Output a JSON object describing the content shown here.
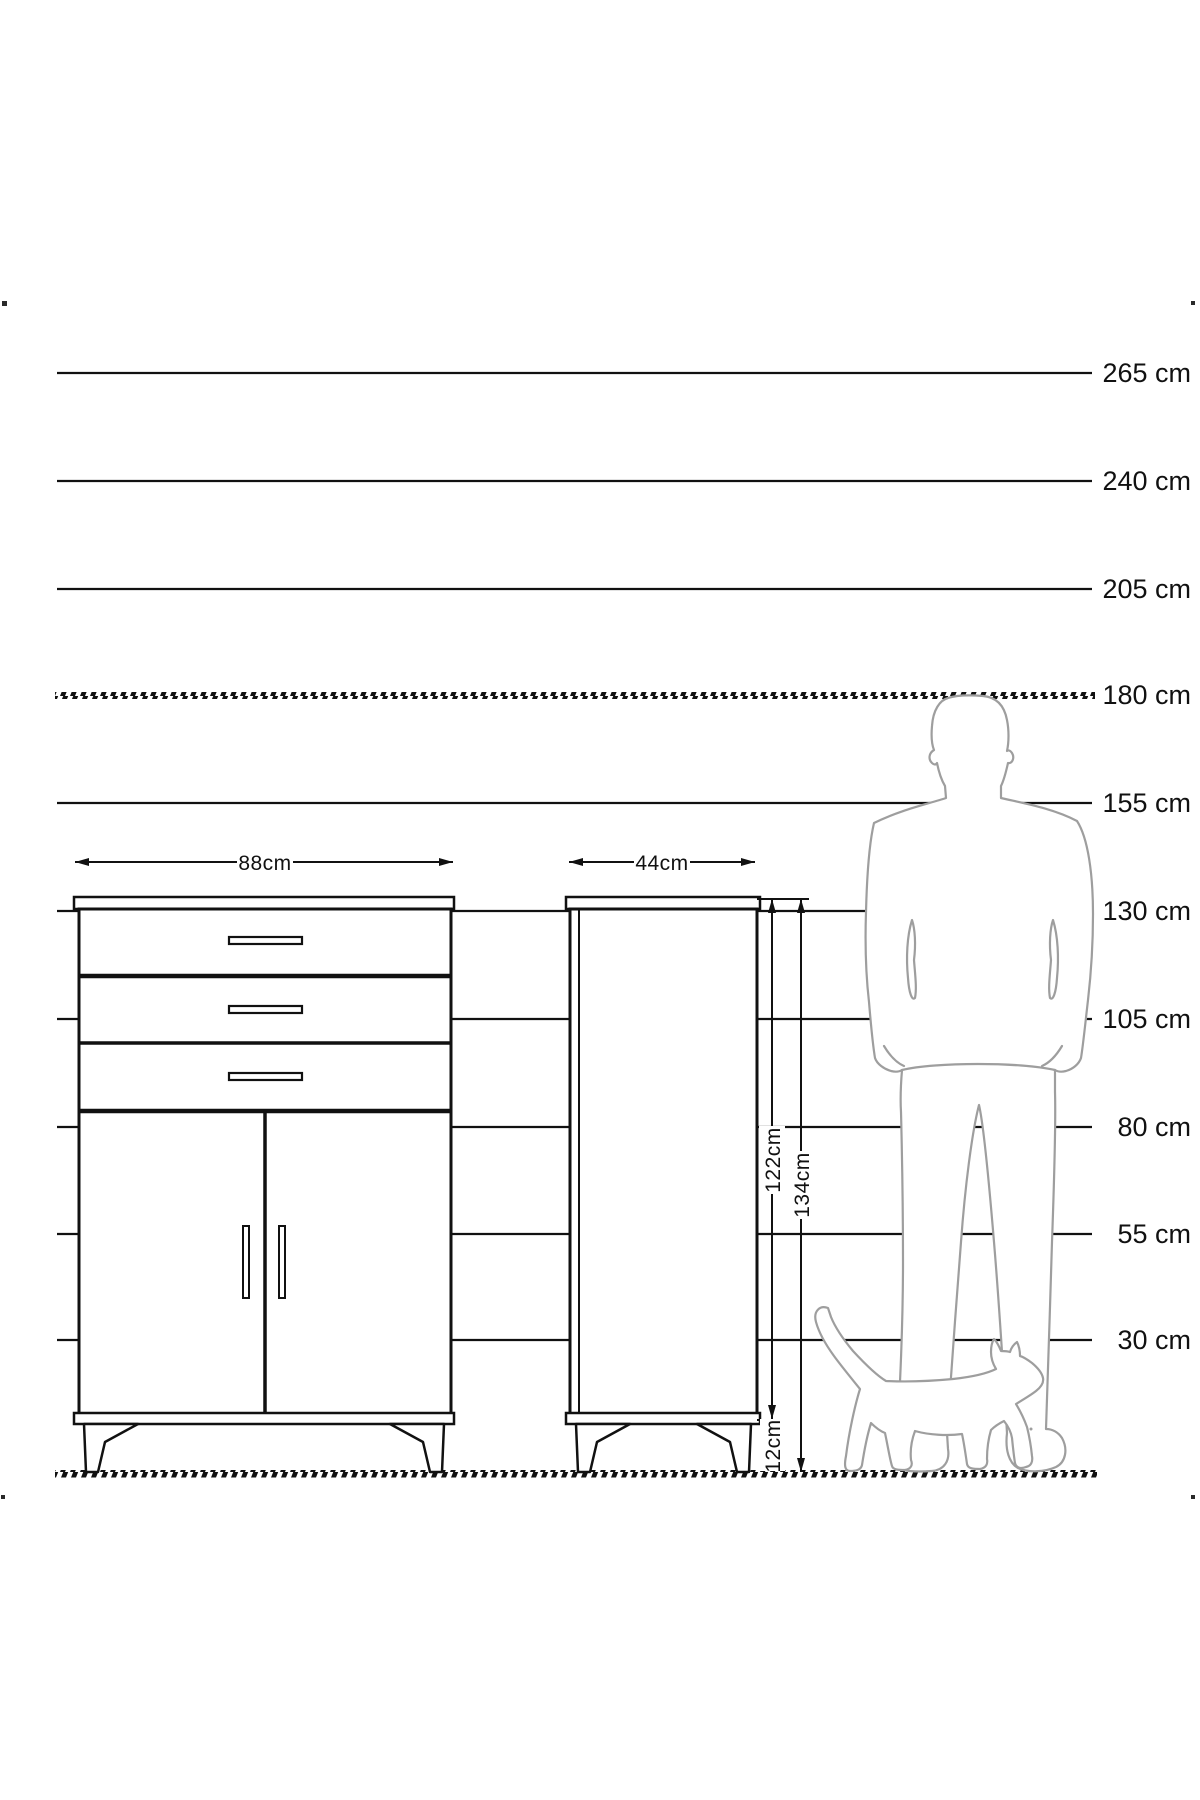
{
  "ruler": {
    "unit": "cm",
    "labels": [
      "265 cm",
      "240 cm",
      "205 cm",
      "180 cm",
      "155 cm",
      "130 cm",
      "105 cm",
      "80 cm",
      "55 cm",
      "30 cm"
    ],
    "values": [
      265,
      240,
      205,
      180,
      155,
      130,
      105,
      80,
      55,
      30
    ],
    "highlighted_values": [
      180
    ],
    "line_color": "#111111"
  },
  "dimensions": {
    "front_width": "88cm",
    "side_width": "44cm",
    "body_height": "122cm",
    "total_height": "134cm",
    "leg_height": "12cm"
  },
  "figures": {
    "silhouette_color": "#9e9e9e",
    "drawing_color": "#111111"
  }
}
